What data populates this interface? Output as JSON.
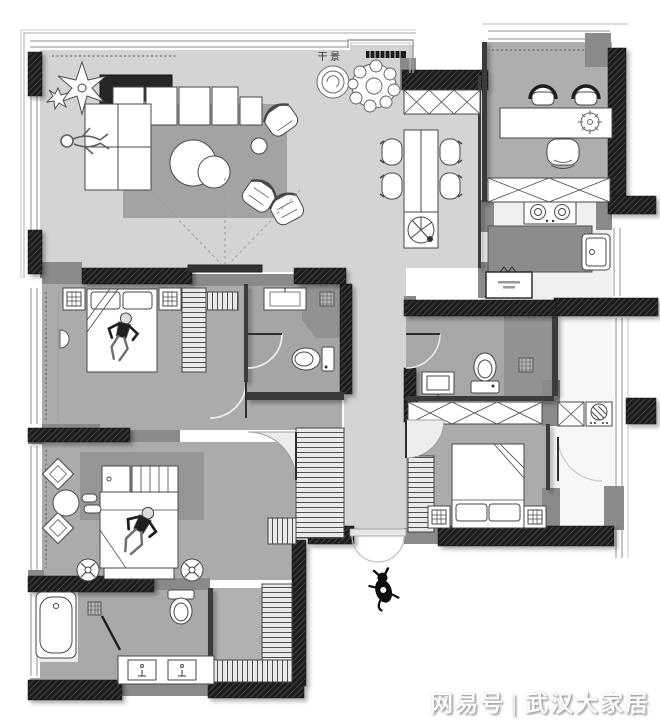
{
  "canvas": {
    "width": 660,
    "height": 724
  },
  "labels": {
    "dry_landscape": "干景"
  },
  "watermark": {
    "brand": "网易号",
    "divider": "|",
    "site": "武汉大家居"
  },
  "palette": {
    "paper": "#ffffff",
    "wall_black": "#1b1b1b",
    "pier_gray": "#8a8a8a",
    "floor_light": "#d4d4d4",
    "floor_mid": "#ababab",
    "floor_bath": "#a5a5a5",
    "rug_living": "#a3a3a3",
    "rug_master": "#969696",
    "shower_gray": "#929292",
    "counter_dark": "#8c8c8c",
    "fixture_white": "#ffffff",
    "outline": "#3a3a3a"
  },
  "rooms": [
    "living-room",
    "dining-area",
    "study",
    "kitchen",
    "hallway",
    "bedroom-1",
    "bathroom-1",
    "bathroom-2",
    "bedroom-2",
    "laundry-room",
    "master-bedroom",
    "walk-in-closet",
    "master-bathroom",
    "entry"
  ],
  "furniture_icons": [
    "sofa",
    "chaise",
    "coffee-table",
    "side-table",
    "armchair",
    "bookcase",
    "rug",
    "projector-screen",
    "plant",
    "dry-landscape-feature",
    "dining-table",
    "dining-chair",
    "desk",
    "guest-chair",
    "office-chair",
    "storage-cabinet-x",
    "bed",
    "pillow",
    "nightstand-lamp",
    "wardrobe",
    "sink",
    "toilet",
    "shower-drain",
    "bathtub",
    "vanity-double-sink",
    "stove",
    "kitchen-island",
    "kitchen-sink",
    "appliance",
    "washing-machine",
    "door-arc",
    "double-entry-door",
    "window",
    "person-figure",
    "dog-figure",
    "wall-lamp",
    "pouf",
    "round-table"
  ]
}
